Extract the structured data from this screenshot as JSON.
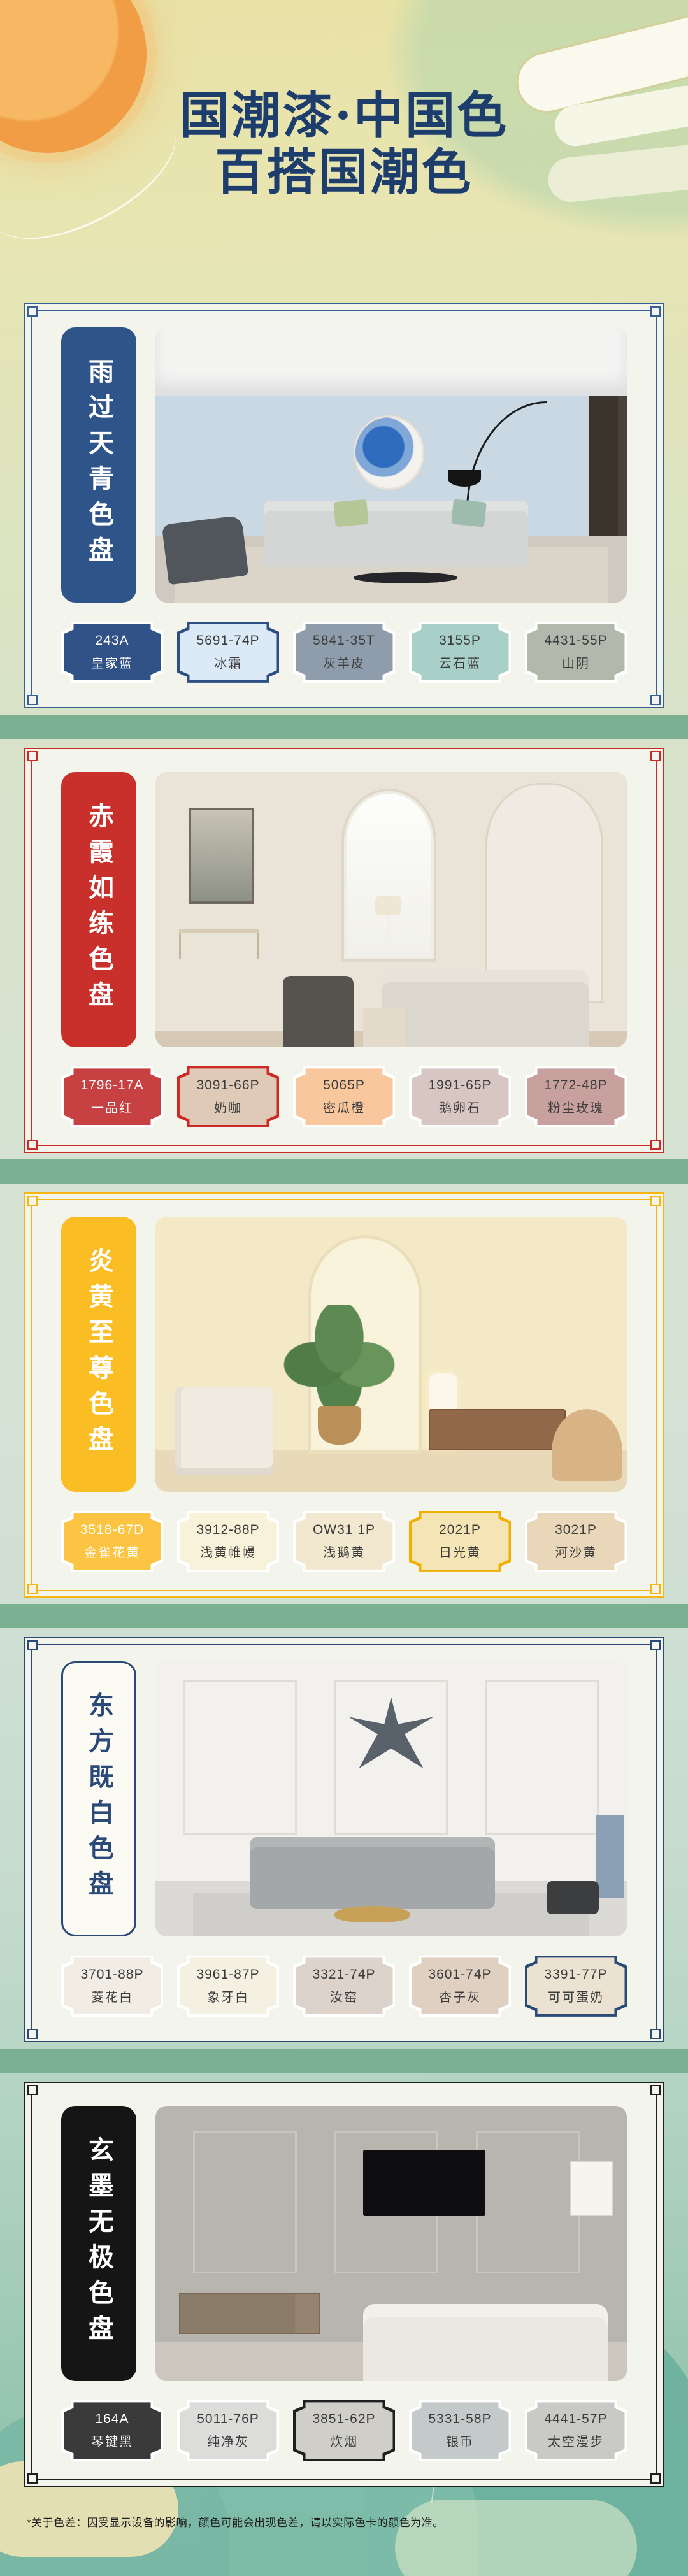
{
  "theme": {
    "page_title_color": "#1d3e6d",
    "band_color": "#7bb092",
    "card_background": "#f3f5ec"
  },
  "header": {
    "title_line1": "国潮漆·中国色",
    "title_line2": "百搭国潮色"
  },
  "footer": {
    "disclaimer": "*关于色差：因受显示设备的影响，颜色可能会出现色差，请以实际色卡的颜色为准。"
  },
  "sections": [
    {
      "id": "s1",
      "title": "雨过天青色盘",
      "accent": "#3a5f92",
      "banner": {
        "bg": "#2e5489",
        "color": "#ffffff"
      },
      "swatches": [
        {
          "code": "243A",
          "name": "皇家蓝",
          "color": "#305287",
          "text": "light"
        },
        {
          "code": "5691-74P",
          "name": "冰霜",
          "color": "#dce9f6",
          "text": "dark",
          "ring": "#2d4f84"
        },
        {
          "code": "5841-35T",
          "name": "灰羊皮",
          "color": "#8f9cab",
          "text": "dark"
        },
        {
          "code": "3155P",
          "name": "云石蓝",
          "color": "#a8cfc8",
          "text": "dark"
        },
        {
          "code": "4431-55P",
          "name": "山阴",
          "color": "#b2b8ab",
          "text": "dark"
        }
      ]
    },
    {
      "id": "s2",
      "title": "赤霞如练色盘",
      "accent": "#ce2a25",
      "banner": {
        "bg": "#c9302b",
        "color": "#ffffff"
      },
      "swatches": [
        {
          "code": "1796-17A",
          "name": "一品红",
          "color": "#c74143",
          "text": "light"
        },
        {
          "code": "3091-66P",
          "name": "奶咖",
          "color": "#dfc9b7",
          "text": "dark",
          "ring": "#ce2a25"
        },
        {
          "code": "5065P",
          "name": "密瓜橙",
          "color": "#f8c79e",
          "text": "dark"
        },
        {
          "code": "1991-65P",
          "name": "鹅卵石",
          "color": "#d7c6c2",
          "text": "dark"
        },
        {
          "code": "1772-48P",
          "name": "粉尘玫瑰",
          "color": "#c8a19e",
          "text": "dark"
        }
      ]
    },
    {
      "id": "s3",
      "title": "炎黄至尊色盘",
      "accent": "#f6b713",
      "banner": {
        "bg": "#fbbd24",
        "color": "#ffffff"
      },
      "swatches": [
        {
          "code": "3518-67D",
          "name": "金雀花黄",
          "color": "#fbc443",
          "text": "light"
        },
        {
          "code": "3912-88P",
          "name": "浅黄帷幔",
          "color": "#f8f2da",
          "text": "dark"
        },
        {
          "code": "OW31 1P",
          "name": "浅鹅黄",
          "color": "#f1e8cf",
          "text": "dark"
        },
        {
          "code": "2021P",
          "name": "日光黄",
          "color": "#f6e5b4",
          "text": "dark",
          "ring": "#f2af00"
        },
        {
          "code": "3021P",
          "name": "河沙黄",
          "color": "#ead7ba",
          "text": "dark"
        }
      ]
    },
    {
      "id": "s4",
      "title": "东方既白色盘",
      "accent": "#2c4a78",
      "banner": {
        "bg": "#fbfbf4",
        "color": "#2c4a78",
        "border": "#2c4a78"
      },
      "swatches": [
        {
          "code": "3701-88P",
          "name": "菱花白",
          "color": "#f1ece4",
          "text": "dark"
        },
        {
          "code": "3961-87P",
          "name": "象牙白",
          "color": "#f4f1e3",
          "text": "dark"
        },
        {
          "code": "3321-74P",
          "name": "汝窑",
          "color": "#ded3ca",
          "text": "dark"
        },
        {
          "code": "3601-74P",
          "name": "杏子灰",
          "color": "#dfd0c2",
          "text": "dark"
        },
        {
          "code": "3391-77P",
          "name": "可可蛋奶",
          "color": "#ece2d2",
          "text": "dark",
          "ring": "#2c4a78"
        }
      ]
    },
    {
      "id": "s5",
      "title": "玄墨无极色盘",
      "accent": "#1f1f1f",
      "banner": {
        "bg": "#151515",
        "color": "#ffffff"
      },
      "swatches": [
        {
          "code": "164A",
          "name": "琴键黑",
          "color": "#3a3a3a",
          "text": "light"
        },
        {
          "code": "5011-76P",
          "name": "纯净灰",
          "color": "#dcdcda",
          "text": "dark"
        },
        {
          "code": "3851-62P",
          "name": "炊烟",
          "color": "#d0cec9",
          "text": "dark",
          "ring": "#1f1f1f"
        },
        {
          "code": "5331-58P",
          "name": "银币",
          "color": "#c4c9ca",
          "text": "dark"
        },
        {
          "code": "4441-57P",
          "name": "太空漫步",
          "color": "#c9c9c6",
          "text": "dark"
        }
      ]
    }
  ]
}
